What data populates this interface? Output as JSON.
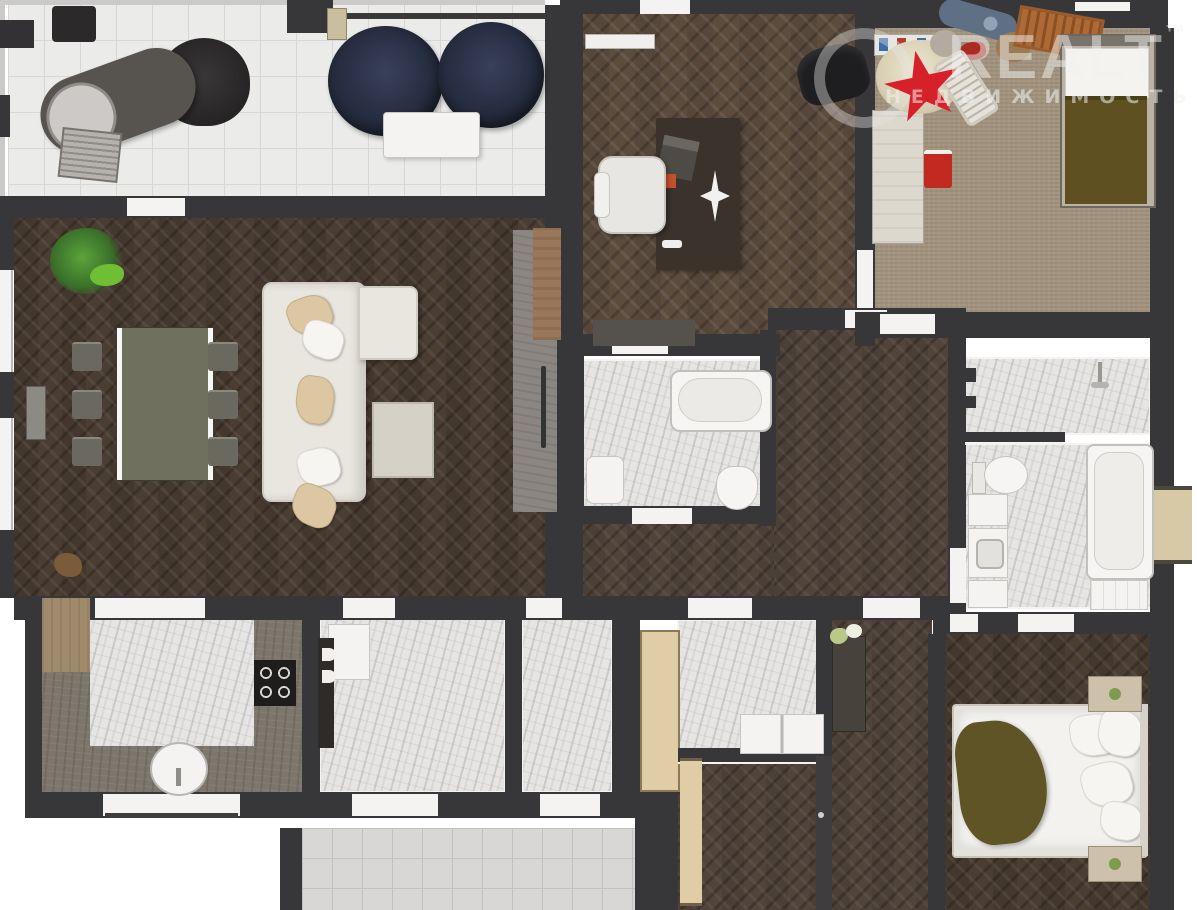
{
  "watermark": {
    "brand": "REALT",
    "trademark": "™",
    "subtitle": "НЕДВИЖИМОСТЬ"
  },
  "colors": {
    "wall": "#37373a",
    "wood_living": "#4a3d32",
    "wood_office": "#5c4c3e",
    "wood_hall": "#51443a",
    "marble": "#e6e5e3",
    "tile": "#ebebe9",
    "tile_dark": "#d8d7d5",
    "carpet": "#a2947e",
    "counter": "#7d766c",
    "sofa": "#e9e6df",
    "navy": "#242b3b",
    "beige_pillow": "#dcc7a2",
    "olive": "#5f5426",
    "olive_dark": "#5e5020",
    "table": "#70705f",
    "nightstand": "#cdc1ab",
    "red_star": "#d6212b",
    "red_chair": "#c02a20",
    "door_beige": "#e0cda5"
  }
}
